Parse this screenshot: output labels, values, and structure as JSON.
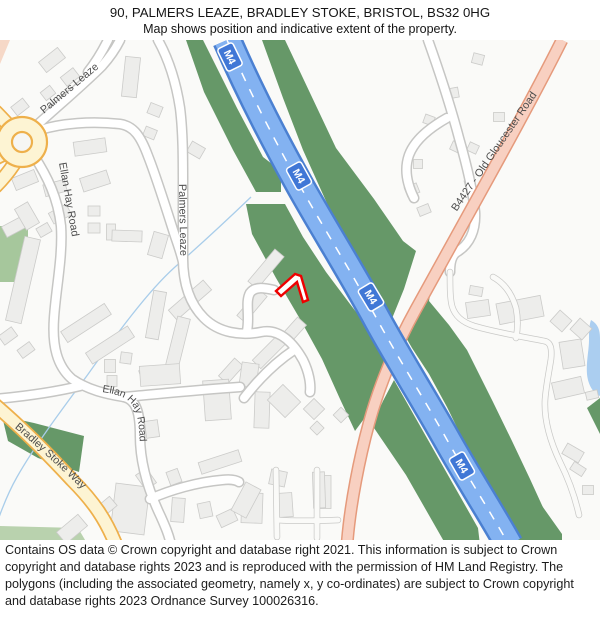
{
  "header": {
    "title": "90, PALMERS LEAZE, BRADLEY STOKE, BRISTOL, BS32 0HG",
    "subtitle": "Map shows position and indicative extent of the property."
  },
  "map": {
    "road_labels": {
      "motorway": "M4",
      "b_road": "B4427 - Old Gloucester Road",
      "palmers_leaze": "Palmers Leaze",
      "ellan_hay_road": "Ellan Hay Road",
      "bradley_stoke_way": "Bradley Stoke Way"
    },
    "colors": {
      "motorway_fill": "#83b2f1",
      "motorway_casing": "#4b80d1",
      "b_road_fill": "#f8d0c1",
      "b_road_casing": "#e59a7c",
      "primary_road_fill": "#fdf4d3",
      "primary_road_casing": "#eeb04b",
      "minor_road_fill": "#ffffff",
      "minor_road_casing": "#c6c6c4",
      "greenspace": "#669868",
      "greenspace_light": "#a6c79c",
      "water": "#abcef0",
      "building_fill": "#ededeb",
      "label_text": "#4c4c4c",
      "property_outline": "#ee0000"
    }
  },
  "footer": {
    "copyright": "Contains OS data © Crown copyright and database right 2021. This information is subject to Crown copyright and database rights 2023 and is reproduced with the permission of HM Land Registry. The polygons (including the associated geometry, namely x, y co-ordinates) are subject to Crown copyright and database rights 2023 Ordnance Survey 100026316."
  }
}
